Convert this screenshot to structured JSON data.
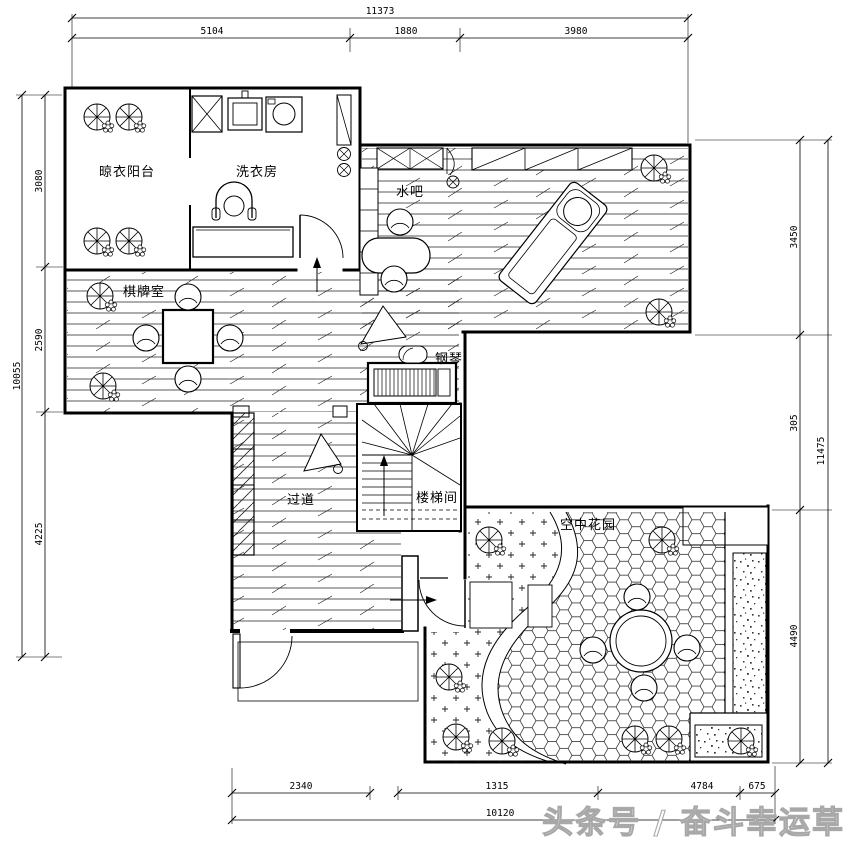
{
  "page": {
    "background": "#ffffff",
    "line_color": "#000000",
    "watermark": "头条号 / 奋斗幸运草",
    "watermark_color": "#a8a8a8"
  },
  "rooms": {
    "drying_balcony": "晾衣阳台",
    "laundry_room": "洗衣房",
    "water_bar": "水吧",
    "chess_card_room": "棋牌室",
    "piano": "钢琴",
    "corridor": "过道",
    "stair_well": "楼梯间",
    "sky_garden": "空中花园"
  },
  "dimensions": {
    "top": {
      "total": "11373",
      "seg1": "5104",
      "seg2": "1880",
      "seg3": "3980"
    },
    "left": {
      "total": "10055",
      "seg1": "3080",
      "seg2": "2590",
      "seg3": "4225"
    },
    "right": {
      "total": "11475",
      "seg1": "3450",
      "seg2": "305",
      "seg3": "4490"
    },
    "bottom": {
      "total": "10120",
      "seg1": "2340",
      "seg2": "1315",
      "seg3": "4784",
      "seg4": "675"
    }
  }
}
